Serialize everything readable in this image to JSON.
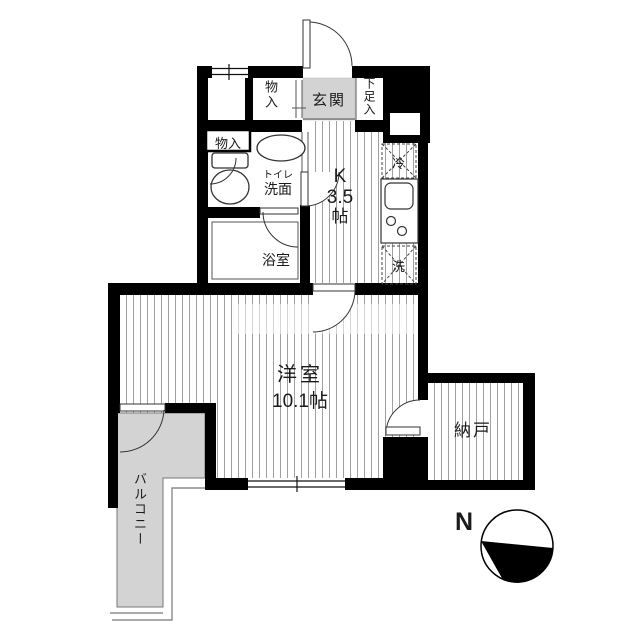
{
  "floorplan": {
    "rooms": {
      "storage_top": {
        "label": "物入"
      },
      "entrance": {
        "label": "玄関"
      },
      "shoe_storage": {
        "label": "下足入"
      },
      "storage_left": {
        "label": "物入"
      },
      "toilet_washroom": {
        "line1": "トイレ",
        "line2": "洗面"
      },
      "bathroom": {
        "label": "浴室"
      },
      "kitchen": {
        "line1": "K",
        "line2": "3.5",
        "line3": "帖"
      },
      "western_room": {
        "label": "洋室",
        "size": "10.1帖"
      },
      "storage_room": {
        "label": "納戸"
      },
      "balcony": {
        "label": "バルコニー"
      }
    },
    "fixtures": {
      "refrigerator_label": "冷",
      "washer_label": "洗"
    },
    "compass": {
      "north_label": "N"
    },
    "colors": {
      "wall": "#000000",
      "floor_gray": "#d3d3d3",
      "hatch_line": "#a0a0a0"
    }
  }
}
